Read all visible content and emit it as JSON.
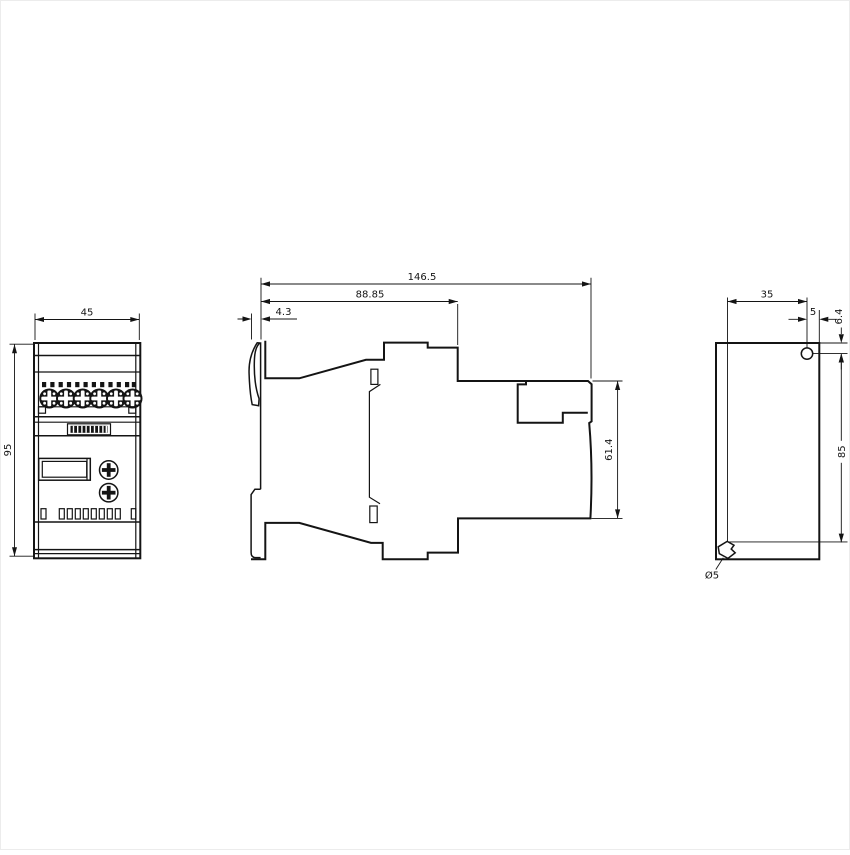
{
  "app": {
    "background": "#ffffff",
    "line_color": "#141414",
    "drawing_type": "engineering-dimension-drawing"
  },
  "views": {
    "front": {
      "label": "front-view",
      "width": "45",
      "height": "95"
    },
    "side": {
      "label": "side-view",
      "overall_depth": "146.5",
      "upper_depth": "88.85",
      "clip_offset": "4.3",
      "rear_height": "61.4"
    },
    "rear": {
      "label": "rear-view",
      "hole_offset_x": "35",
      "hole_edge_offset": "5",
      "hole_top_offset": "6.4",
      "hole_pitch": "85",
      "hole_diameter": "Ø5"
    }
  }
}
